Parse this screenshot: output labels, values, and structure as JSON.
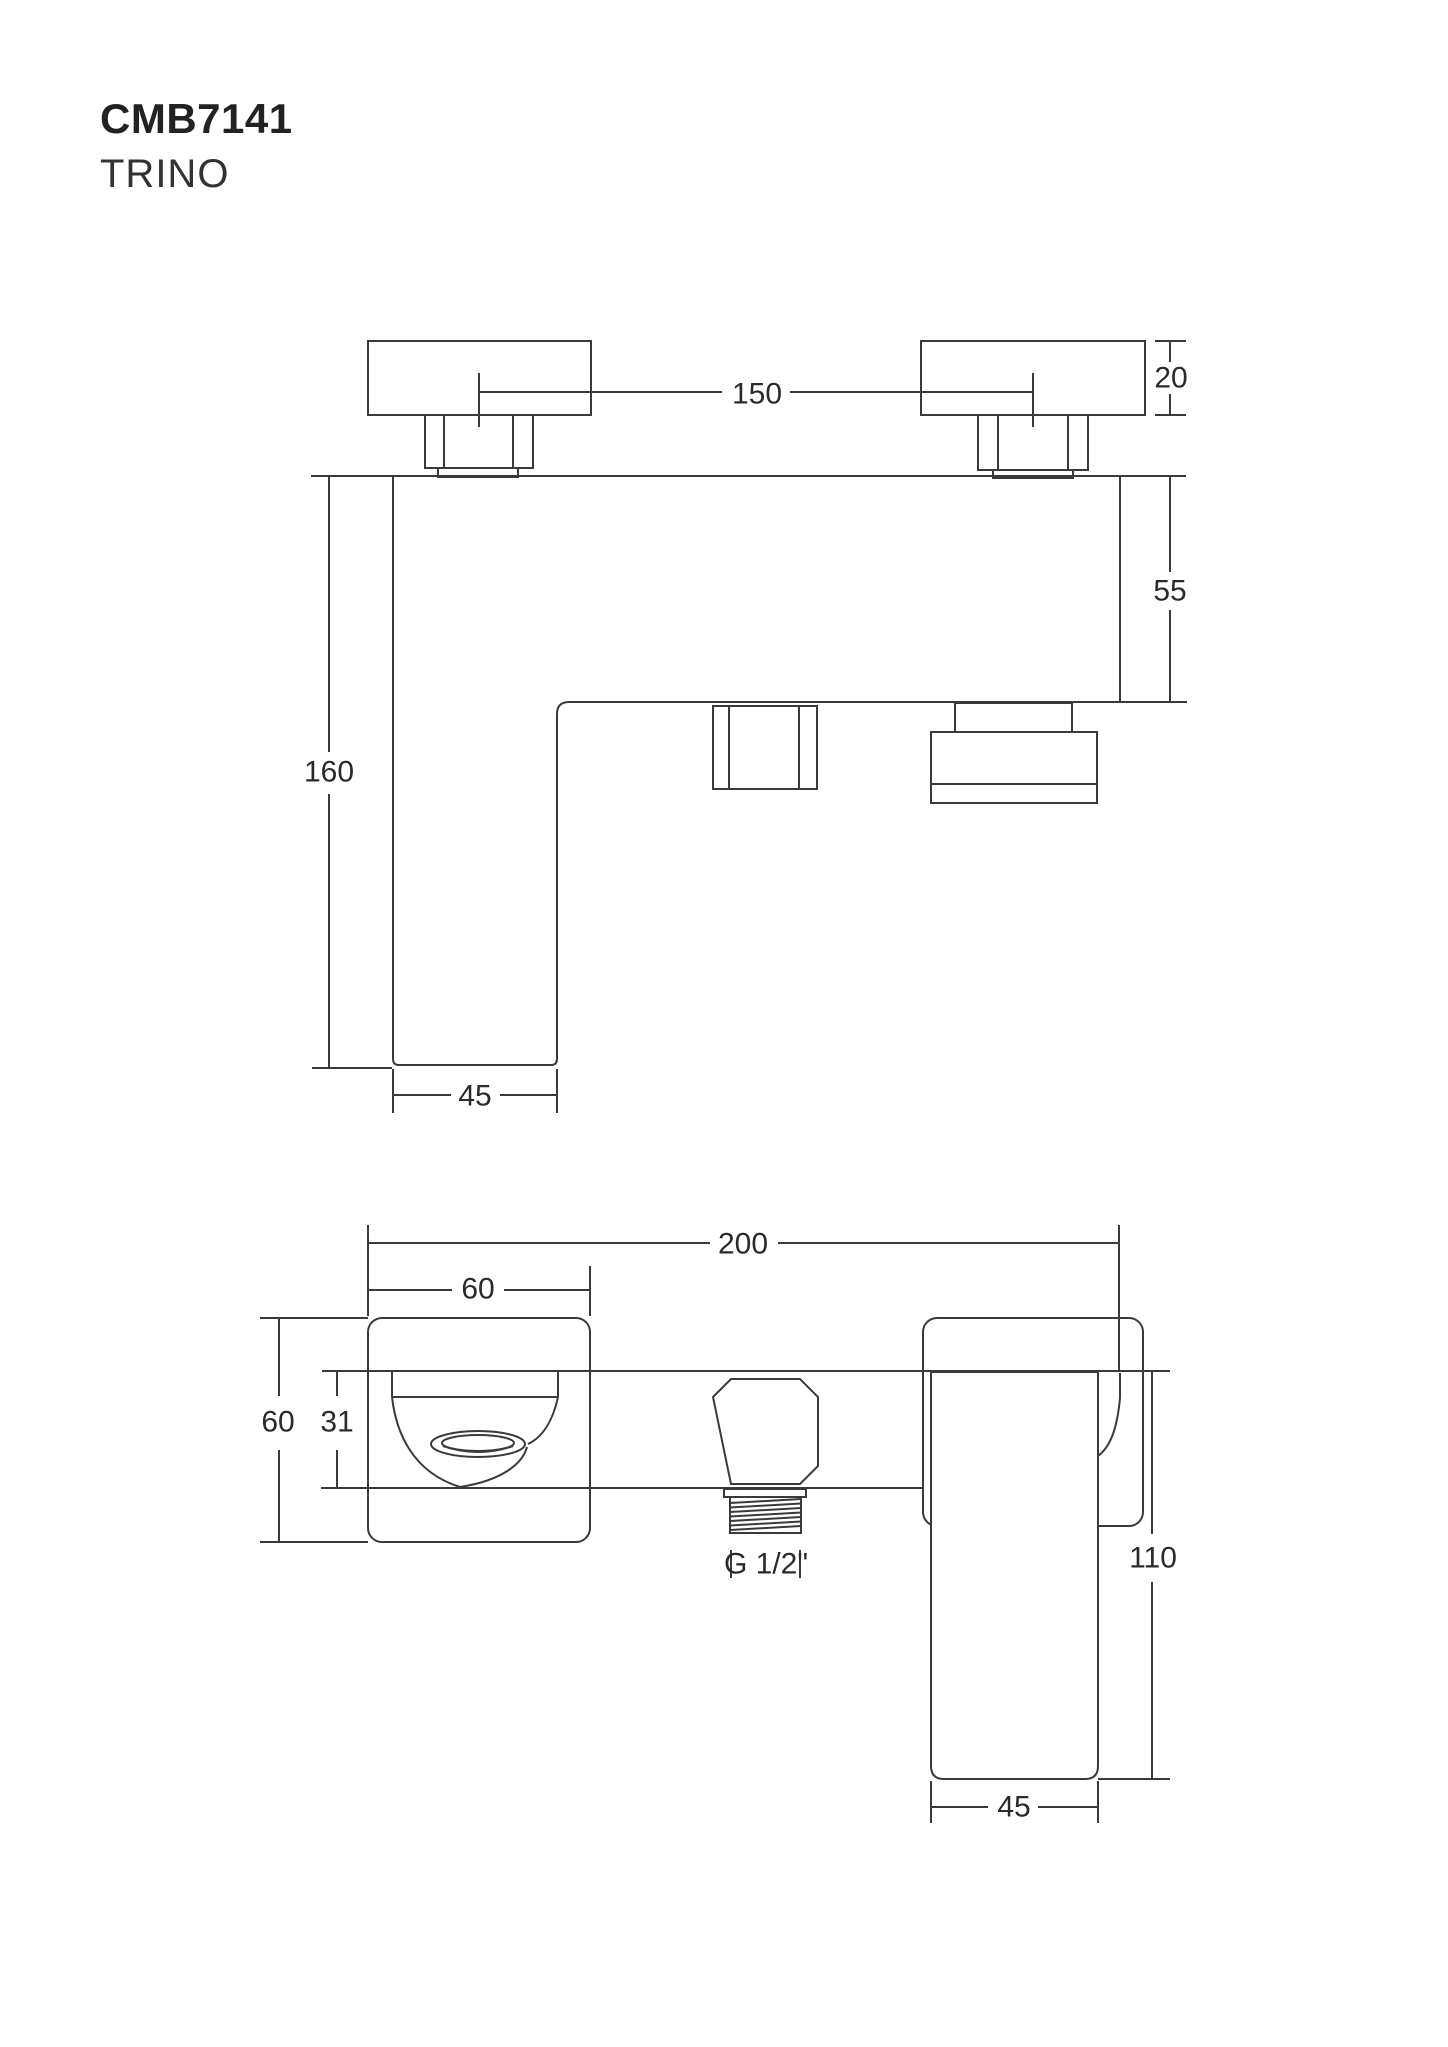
{
  "page": {
    "background": "#ffffff",
    "line_color": "#3a3a3a",
    "text_color": "#2a2a2a"
  },
  "header": {
    "model": "CMB7141",
    "series": "TRINO"
  },
  "side_view": {
    "dim_between_centers": "150",
    "dim_flange_height": "20",
    "dim_body_depth": "55",
    "dim_total_height": "160",
    "dim_spout_width": "45"
  },
  "front_view": {
    "dim_overall_width": "200",
    "dim_flange_width": "60",
    "dim_flange_height": "60",
    "dim_body_height": "31",
    "dim_handle_height": "110",
    "dim_handle_width": "45",
    "dim_thread": "G 1/2\""
  }
}
